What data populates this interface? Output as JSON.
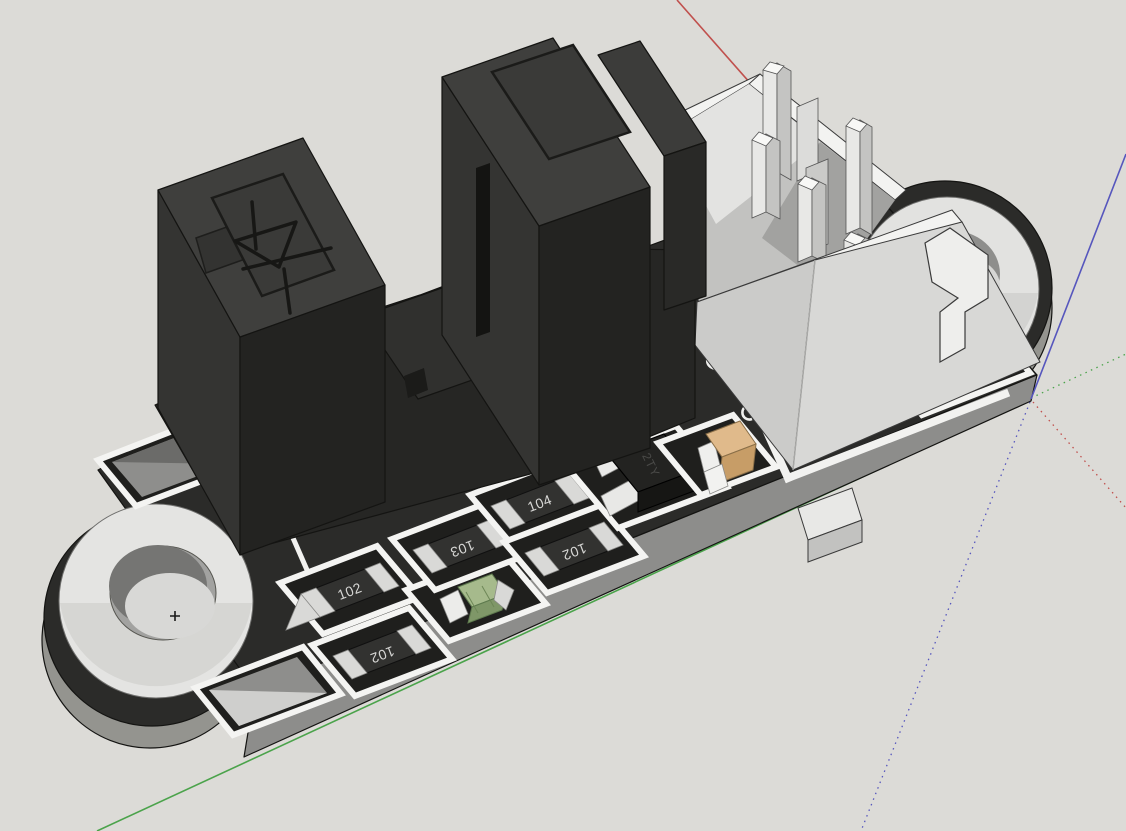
{
  "viewport": {
    "type": "3d-model-view",
    "background_color": "#dcdbd7"
  },
  "axes": {
    "red_color": "#c0504d",
    "green_color": "#4ba34b",
    "blue_color": "#5656bd"
  },
  "board": {
    "name": "speed sensor module PCB",
    "top_color": "#2b2b29",
    "side_color": "#8d8d8b",
    "silkscreen_color": "#f2f2f0"
  },
  "components": {
    "photo_interrupter": {
      "name": "slot-type photo interrupter",
      "mark": "diode symbol"
    },
    "connector": {
      "name": "4-pin header connector"
    },
    "resistors": [
      {
        "label": "102"
      },
      {
        "label": "102"
      },
      {
        "label": "103"
      },
      {
        "label": "104"
      },
      {
        "label": "102"
      }
    ],
    "transistor": {
      "label": "2TY"
    },
    "led": {
      "body_color": "#a6ba8c"
    },
    "capacitor": {
      "body_color": "#e0ba8b"
    },
    "mounting_holes": [
      {
        "position": "left"
      },
      {
        "position": "right"
      }
    ]
  }
}
